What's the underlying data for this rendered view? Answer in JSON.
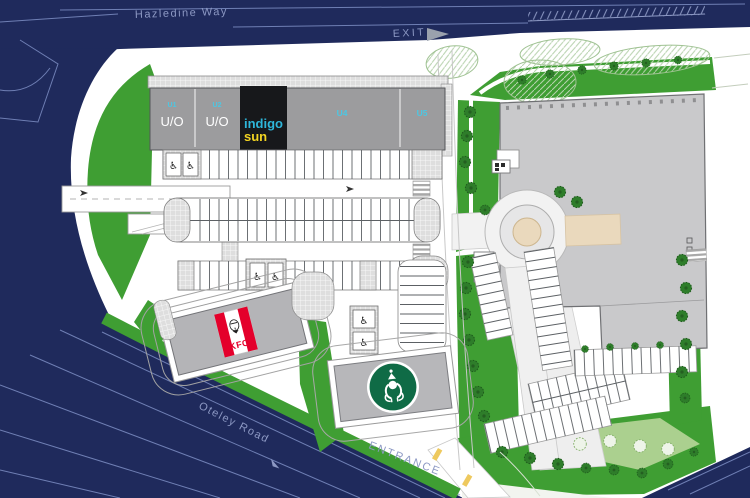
{
  "plan": {
    "roads": {
      "hazledine_way": "Hazledine Way",
      "exit": "EXIT",
      "oteley_road": "Oteley Road",
      "entrance": "ENTRANCE"
    },
    "units": {
      "u1": {
        "label": "U1",
        "status": "U/O"
      },
      "u2": {
        "label": "U2",
        "status": "U/O"
      },
      "u3": {
        "brand_line1": "indigo",
        "brand_line2": "sun"
      },
      "u4": {
        "label": "U4"
      },
      "u5": {
        "label": "U5"
      }
    },
    "tenants": {
      "kfc": {
        "label": "KFC"
      }
    },
    "icons": {
      "disabled_bay": "♿"
    },
    "colors": {
      "navy": "#1f2a5c",
      "road_line": "#6f7fb4",
      "label_text": "#8d99c4",
      "green": "#3f9e33",
      "tree": "#2e7d2a",
      "light_green": "#abd08f",
      "terrace_grey": "#9c9c9e",
      "building_grey": "#c9c9cb",
      "unit_cyan": "#4cc7e3",
      "indigo_cyan": "#2eb6da",
      "sun_yellow": "#f2d322",
      "indigo_box": "#17181b",
      "kfc_red": "#e4002b",
      "starbucks_green": "#0f6b46",
      "tan": "#ead9bd",
      "kerb_yellow": "#eec95e"
    }
  }
}
